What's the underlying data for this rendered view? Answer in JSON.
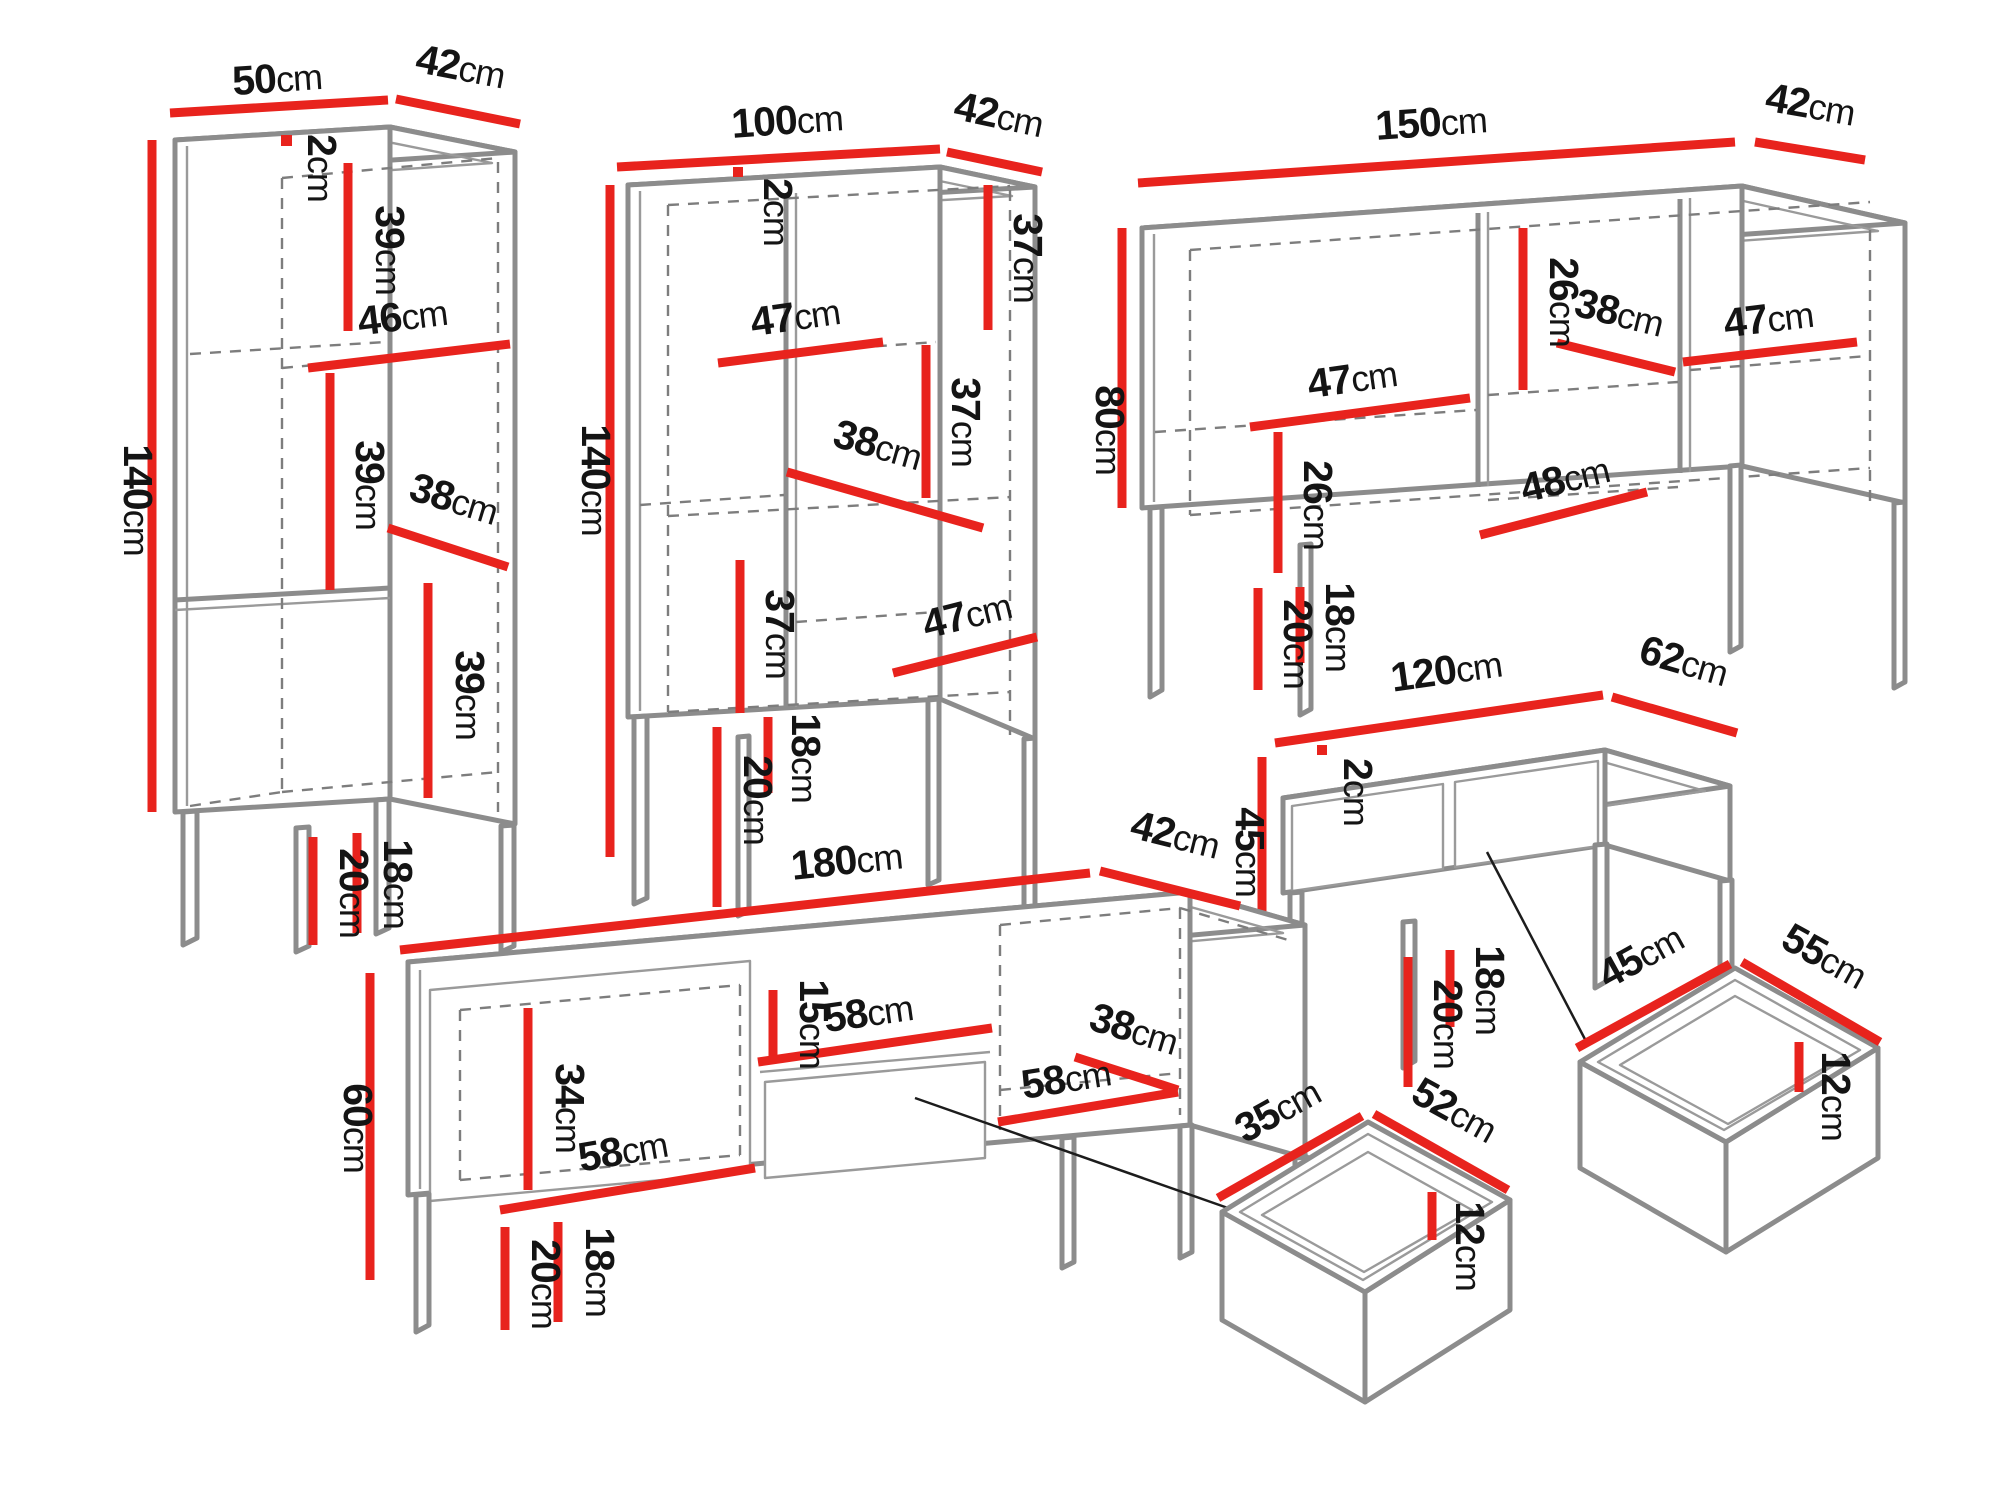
{
  "unit": "cm",
  "accent_color": "#e8231d",
  "outline_color": "#8c8c8c",
  "pieces": {
    "tall_cabinet": {
      "width": "50",
      "depth": "42",
      "height": "140",
      "top_thickness": "2",
      "section_top": "39",
      "inner_width_top": "46",
      "section_middle": "39",
      "inner_width_bottom": "38",
      "section_bottom": "39",
      "leg_inner": "18",
      "leg_outer": "20"
    },
    "display_cabinet": {
      "width": "100",
      "depth": "42",
      "height": "140",
      "top_thickness": "2",
      "right_top": "37",
      "shelf_left": "47",
      "right_middle": "37",
      "inner_mid": "38",
      "left_bottom": "37",
      "bottom_right": "47",
      "leg_inner": "18",
      "leg_outer": "20"
    },
    "sideboard": {
      "width": "150",
      "depth": "42",
      "height": "80",
      "upper_inner": "26",
      "inner_mid": "38",
      "shelf_right": "47",
      "shelf_left": "47",
      "lower_inner": "26",
      "bottom_inner": "48",
      "leg_inner": "18",
      "leg_outer": "20"
    },
    "coffee_table": {
      "width": "120",
      "depth": "62",
      "height": "45",
      "top_thickness": "2",
      "leg_inner": "18",
      "leg_outer": "20"
    },
    "tv_stand": {
      "width": "180",
      "depth": "42",
      "height": "60",
      "door_inner": "34",
      "bottom_left_width": "58",
      "niche_height": "15",
      "niche_width": "58",
      "right_depth": "38",
      "right_width": "58",
      "leg_inner": "18",
      "leg_outer": "20"
    },
    "drawer_small": {
      "width": "35",
      "depth": "52",
      "height": "12"
    },
    "drawer_large": {
      "width": "45",
      "depth": "55",
      "height": "12"
    }
  }
}
